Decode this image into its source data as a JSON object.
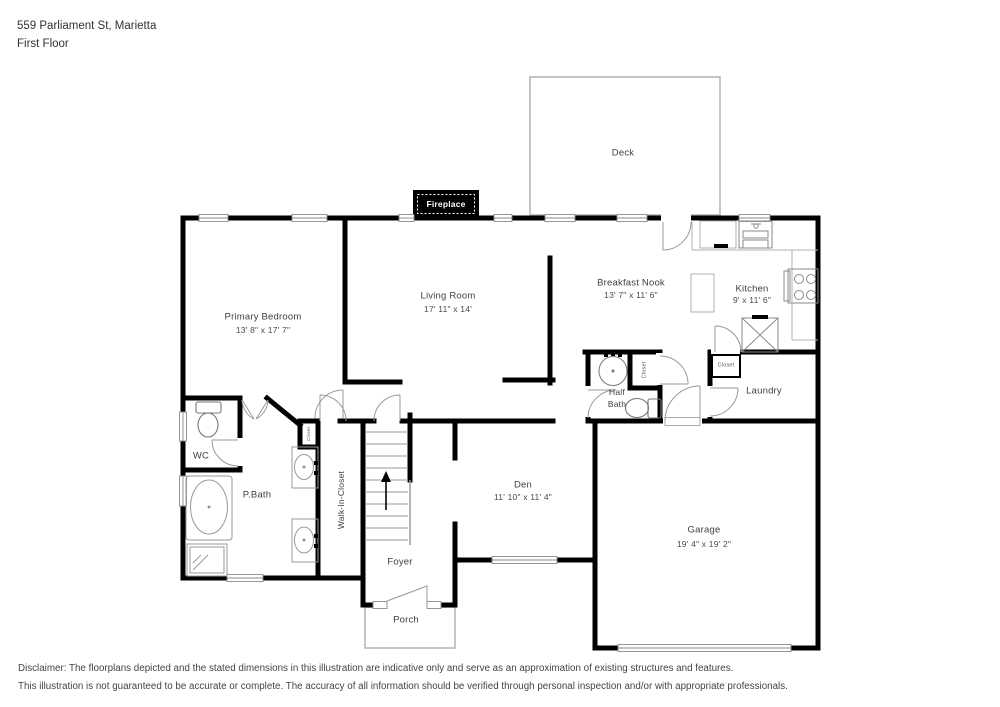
{
  "header": {
    "address": "559 Parliament St, Marietta",
    "floor": "First Floor"
  },
  "rooms": {
    "deck": {
      "name": "Deck"
    },
    "fireplace": {
      "name": "Fireplace"
    },
    "living_room": {
      "name": "Living Room",
      "dims": "17' 11\" x 14'"
    },
    "breakfast_nook": {
      "name": "Breakfast Nook",
      "dims": "13' 7\" x 11' 6\""
    },
    "kitchen": {
      "name": "Kitchen",
      "dims": "9' x 11' 6\""
    },
    "primary_bedroom": {
      "name": "Primary Bedroom",
      "dims": "13' 8\" x 17' 7\""
    },
    "half_bath": {
      "line1": "Half",
      "line2": "Bath"
    },
    "laundry": {
      "name": "Laundry"
    },
    "wc": {
      "name": "WC"
    },
    "p_bath": {
      "name": "P.Bath"
    },
    "walk_in_closet": {
      "name": "Walk-In-Closet"
    },
    "den": {
      "name": "Den",
      "dims": "11' 10\" x 11' 4\""
    },
    "foyer": {
      "name": "Foyer"
    },
    "porch": {
      "name": "Porch"
    },
    "garage": {
      "name": "Garage",
      "dims": "19' 4\" x 19' 2\""
    },
    "closet_half_bath": {
      "name": "Closet"
    },
    "closet_laundry": {
      "name": "Closet"
    },
    "closet_hall": {
      "name": "Closet"
    }
  },
  "disclaimer": {
    "line1": "Disclaimer: The floorplans depicted and the stated dimensions in this illustration are indicative only and serve as an approximation of existing structures and features.",
    "line2": "This illustration is not guaranteed to be accurate or complete. The accuracy of all information should be verified through personal inspection and/or with appropriate professionals."
  },
  "colors": {
    "wall": "#000000",
    "fixture": "#8a8a8a",
    "outline": "#b3b3b3",
    "text": "#3d3d3d"
  },
  "icons": [
    "toilet-icon",
    "sink-icon",
    "bathtub-icon",
    "shower-icon",
    "stove-icon",
    "kitchen-sink-icon",
    "pantry-icon",
    "staircase-icon",
    "up-arrow-icon",
    "door-swing",
    "window",
    "garage-door"
  ]
}
